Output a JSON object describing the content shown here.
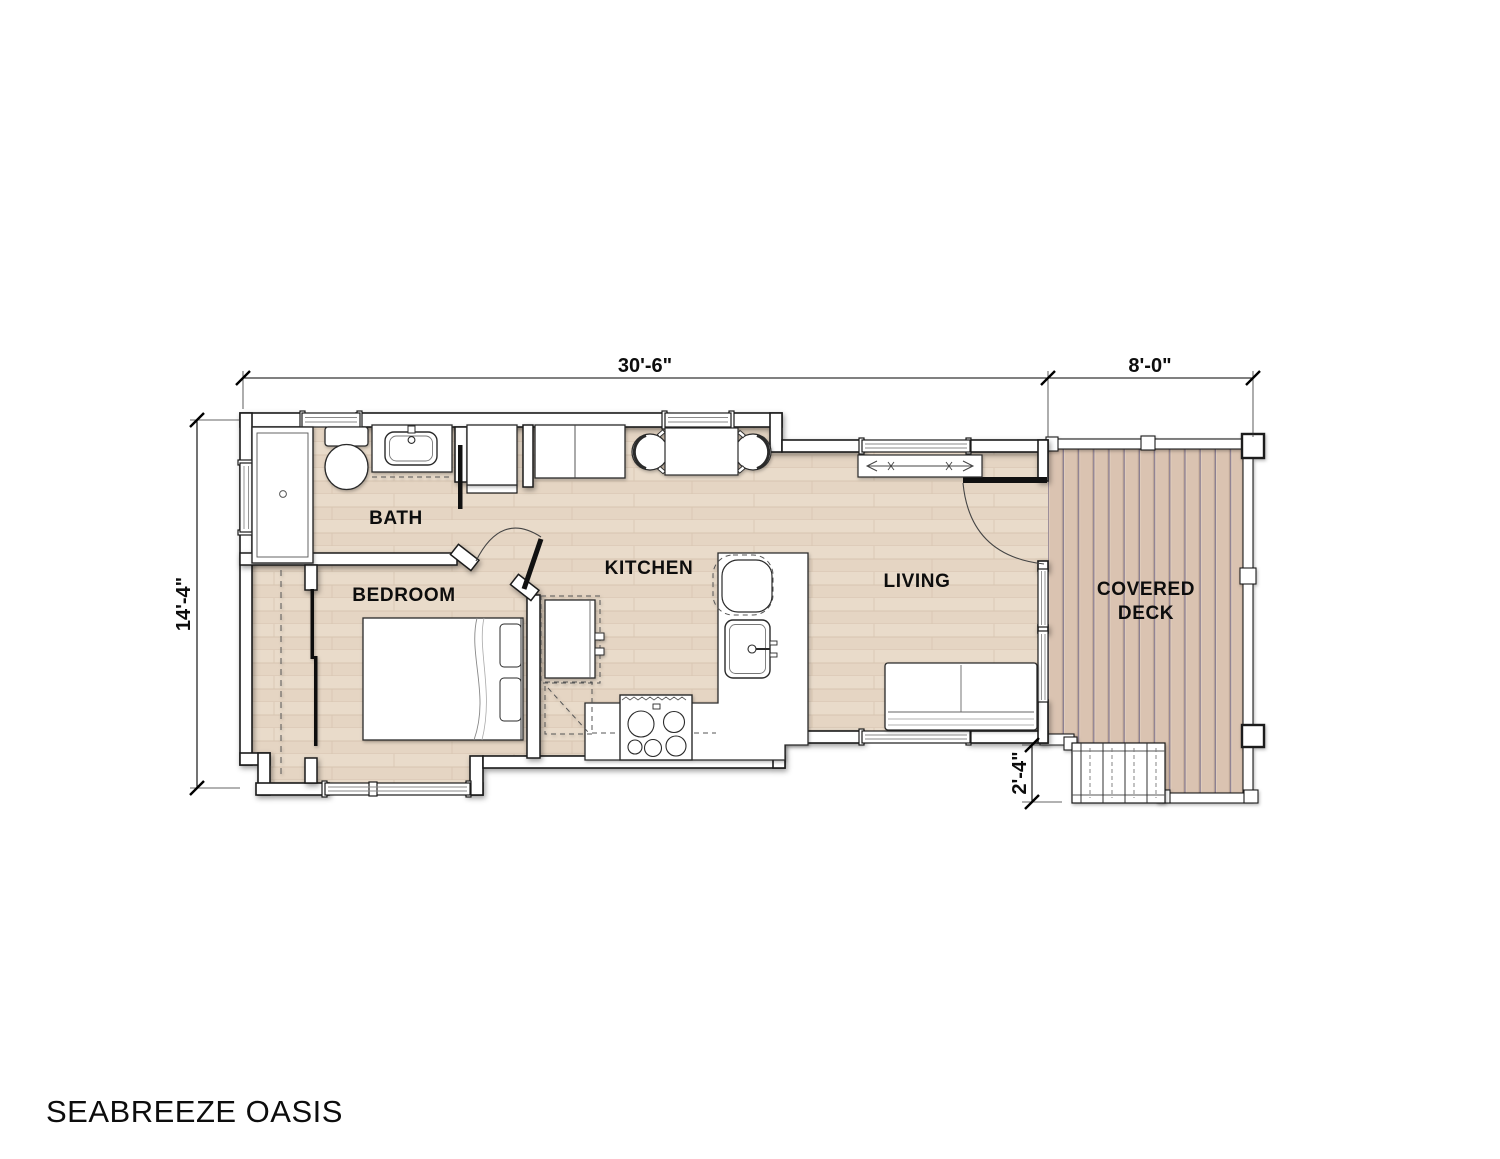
{
  "title": "SEABREEZE OASIS",
  "rooms": {
    "bath": {
      "label": "BATH"
    },
    "bedroom": {
      "label": "BEDROOM"
    },
    "kitchen": {
      "label": "KITCHEN"
    },
    "living": {
      "label": "LIVING"
    },
    "covered_deck": {
      "label_line1": "COVERED",
      "label_line2": "DECK"
    }
  },
  "dimensions": {
    "main_width": "30'-6\"",
    "deck_width": "8'-0\"",
    "main_depth": "14'-4\"",
    "stair_depth": "2'-4\""
  },
  "colors": {
    "interior_floor": "#e9dbca",
    "interior_plank_line": "#d6c4b0",
    "deck_floor": "#dac3b1",
    "deck_plank_line": "#8c7f92",
    "wall_fill": "#ffffff",
    "line": "#1a1a1a"
  }
}
